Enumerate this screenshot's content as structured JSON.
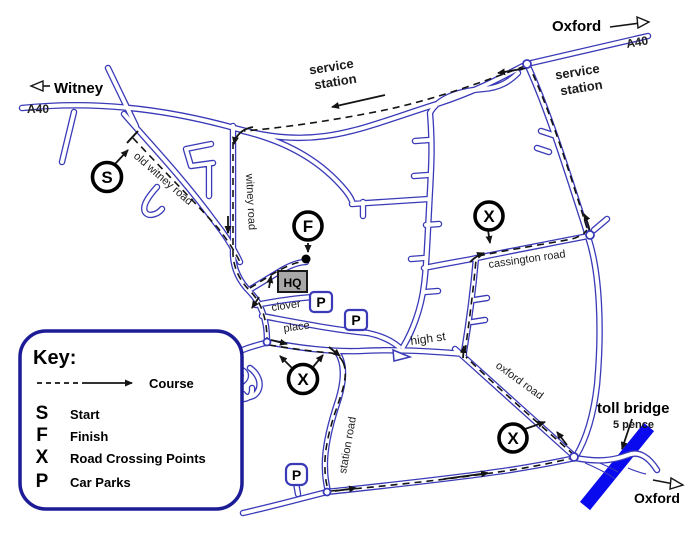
{
  "map_labels": {
    "oxford_top": "Oxford",
    "a40_top_right": "A40",
    "witney": "Witney",
    "a40_left": "A40",
    "service_station": {
      "line1": "service",
      "line2": "station"
    },
    "toll_bridge": {
      "name": "toll bridge",
      "price": "5 pence"
    },
    "oxford_bottom": "Oxford",
    "hq": "HQ"
  },
  "roads": {
    "old_witney_road": "old witney road",
    "witney_road": "witney road",
    "cassington_road": "cassington road",
    "high_st": "high st",
    "oxford_road": "oxford road",
    "station_road": "station road",
    "clover": "clover",
    "place": "place"
  },
  "markers": {
    "start": "S",
    "finish": "F",
    "crossing": "X",
    "car_park": "P"
  },
  "key": {
    "title": "Key:",
    "course_label": "Course",
    "items": [
      {
        "symbol": "S",
        "label": "Start"
      },
      {
        "symbol": "F",
        "label": "Finish"
      },
      {
        "symbol": "X",
        "label": "Road Crossing Points"
      },
      {
        "symbol": "P",
        "label": "Car Parks"
      }
    ]
  },
  "colors": {
    "road": "#3a3ab8",
    "course": "#141414",
    "key_border": "#1c1c96",
    "river": "#0a0aee",
    "hq_fill": "#a8a8a8"
  }
}
